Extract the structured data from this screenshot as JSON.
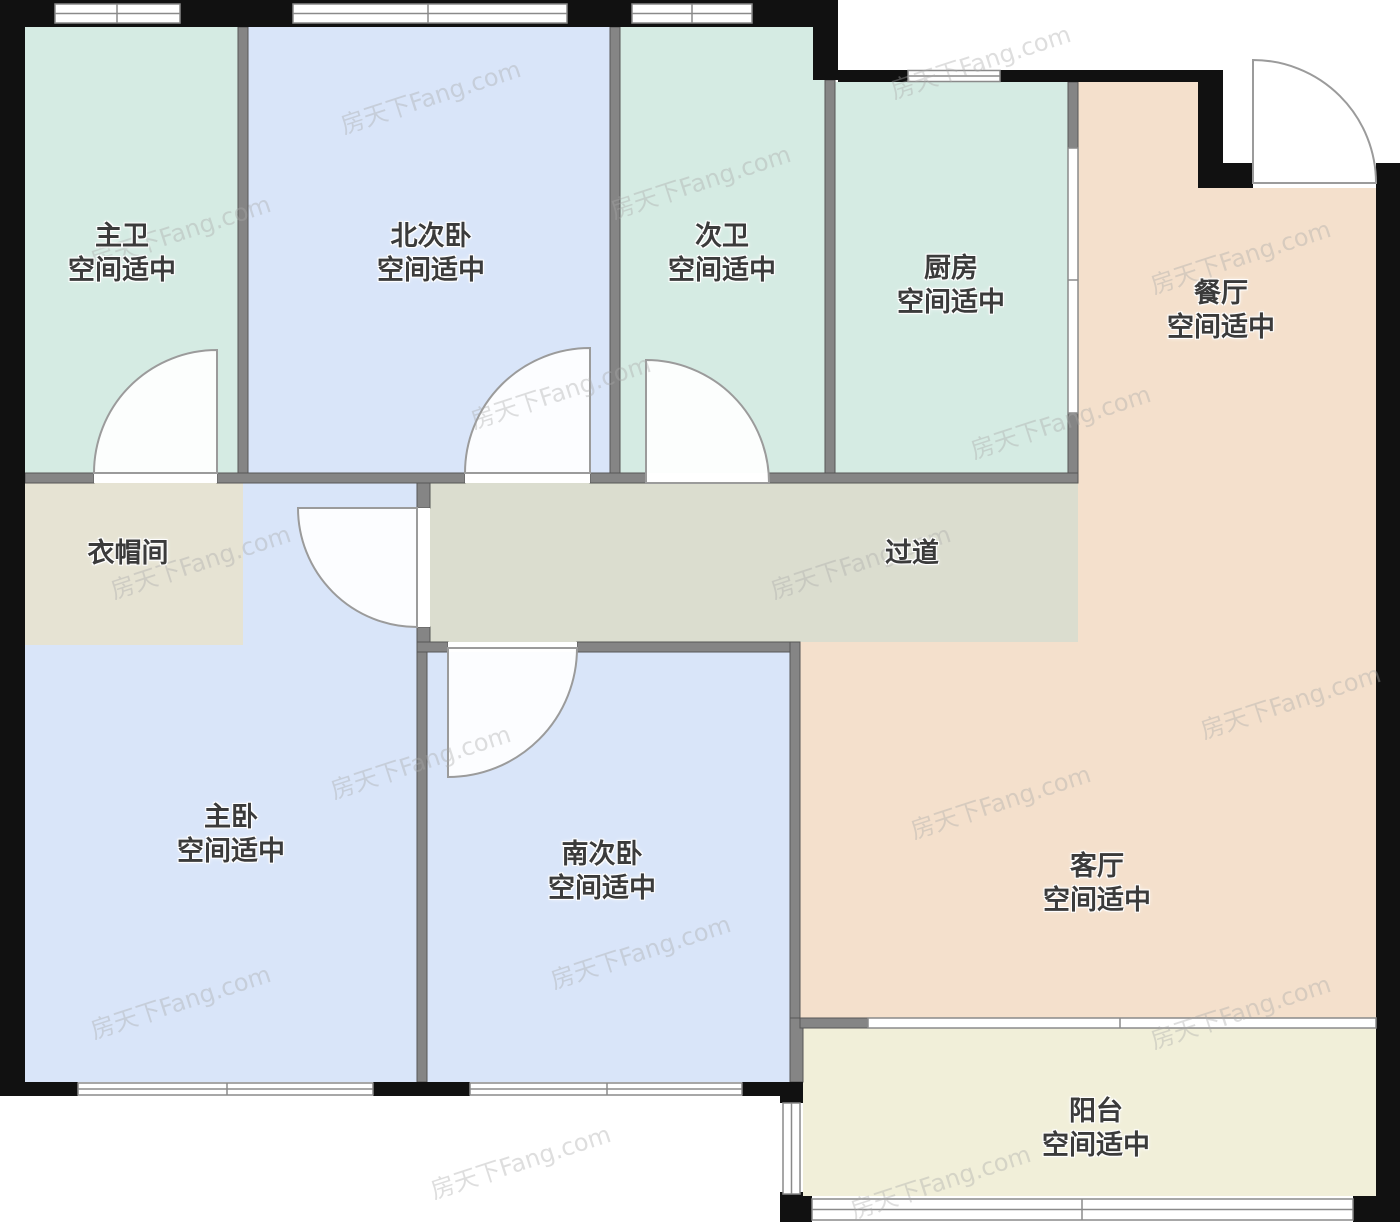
{
  "title": "户型图",
  "watermark": {
    "text": "房天下Fang.com"
  },
  "rooms": [
    {
      "id": "master-bath",
      "name": "主卫",
      "note": "空间适中"
    },
    {
      "id": "north-bedroom",
      "name": "北次卧",
      "note": "空间适中"
    },
    {
      "id": "second-bath",
      "name": "次卫",
      "note": "空间适中"
    },
    {
      "id": "kitchen",
      "name": "厨房",
      "note": "空间适中"
    },
    {
      "id": "dining-room",
      "name": "餐厅",
      "note": "空间适中"
    },
    {
      "id": "cloakroom",
      "name": "衣帽间",
      "note": ""
    },
    {
      "id": "hallway",
      "name": "过道",
      "note": ""
    },
    {
      "id": "master-bedroom",
      "name": "主卧",
      "note": "空间适中"
    },
    {
      "id": "south-bedroom",
      "name": "南次卧",
      "note": "空间适中"
    },
    {
      "id": "living-room",
      "name": "客厅",
      "note": "空间适中"
    },
    {
      "id": "balcony",
      "name": "阳台",
      "note": "空间适中"
    }
  ],
  "colors": {
    "bath": "#d5ebe3",
    "bedroom": "#d9e5f9",
    "kitchen": "#d5ebe3",
    "dining": "#f4e0cc",
    "living": "#f4e0cc",
    "balcony": "#f1efd9",
    "cloakroom": "#e6e3d3",
    "hallway": "#dbddcf",
    "wall_outer": "#111111",
    "wall_inner": "#858585"
  }
}
